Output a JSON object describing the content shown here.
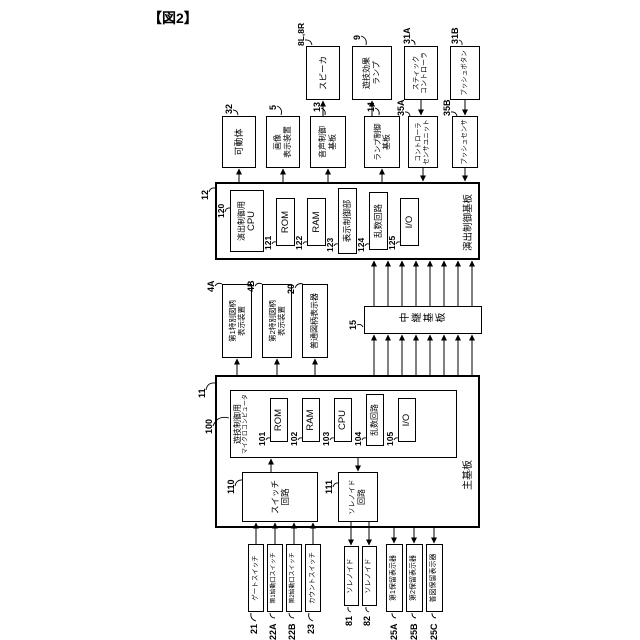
{
  "figure_label": "【図2】",
  "colors": {
    "ink": "#000000",
    "paper": "#ffffff"
  },
  "diagram": {
    "boxes": [
      {
        "name": "main-board",
        "x": 112,
        "y": 215,
        "w": 153,
        "h": 265,
        "bw": 2,
        "lines": []
      },
      {
        "name": "effect-control-board",
        "x": 380,
        "y": 215,
        "w": 78,
        "h": 265,
        "bw": 2,
        "lines": []
      },
      {
        "name": "game-control-microcomputer",
        "x": 182,
        "y": 230,
        "w": 68,
        "h": 227,
        "bw": 1.5,
        "align": "top",
        "lines": [
          {
            "t": "遊技制御用",
            "fs": 8
          },
          {
            "t": "マイクロコンピュータ",
            "fs": 6
          }
        ]
      },
      {
        "name": "relay-board",
        "x": 306,
        "y": 364,
        "w": 28,
        "h": 118,
        "bw": 1.5,
        "vert": true,
        "lines": [
          {
            "t": "中継基板",
            "fs": 10
          }
        ]
      },
      {
        "name": "gate-switch",
        "x": 28,
        "y": 248,
        "w": 68,
        "h": 16,
        "lines": [
          {
            "t": "ゲートスイッチ",
            "fs": 6.5
          }
        ]
      },
      {
        "name": "first-start-switch",
        "x": 28,
        "y": 267,
        "w": 68,
        "h": 16,
        "lines": [
          {
            "t": "第1始動口スイッチ",
            "fs": 6
          }
        ]
      },
      {
        "name": "second-start-switch",
        "x": 28,
        "y": 286,
        "w": 68,
        "h": 16,
        "lines": [
          {
            "t": "第2始動口スイッチ",
            "fs": 6
          }
        ]
      },
      {
        "name": "count-switch",
        "x": 28,
        "y": 305,
        "w": 68,
        "h": 16,
        "lines": [
          {
            "t": "カウントスイッチ",
            "fs": 6.5
          }
        ]
      },
      {
        "name": "solenoid-81",
        "x": 34,
        "y": 344,
        "w": 60,
        "h": 15,
        "lines": [
          {
            "t": "ソレノイド",
            "fs": 7
          }
        ]
      },
      {
        "name": "solenoid-82",
        "x": 34,
        "y": 362,
        "w": 60,
        "h": 15,
        "lines": [
          {
            "t": "ソレノイド",
            "fs": 7
          }
        ]
      },
      {
        "name": "first-hold-display",
        "x": 28,
        "y": 386,
        "w": 68,
        "h": 17,
        "lines": [
          {
            "t": "第1保留表示器",
            "fs": 7
          }
        ]
      },
      {
        "name": "second-hold-display",
        "x": 28,
        "y": 406,
        "w": 68,
        "h": 17,
        "lines": [
          {
            "t": "第2保留表示器",
            "fs": 7
          }
        ]
      },
      {
        "name": "normal-hold-display",
        "x": 28,
        "y": 426,
        "w": 68,
        "h": 17,
        "lines": [
          {
            "t": "普図保留表示器",
            "fs": 7
          }
        ]
      },
      {
        "name": "switch-circuit",
        "x": 118,
        "y": 242,
        "w": 50,
        "h": 76,
        "lines": [
          {
            "t": "スイッチ",
            "fs": 8.5
          },
          {
            "t": "回路",
            "fs": 8.5
          }
        ]
      },
      {
        "name": "solenoid-circuit",
        "x": 118,
        "y": 338,
        "w": 50,
        "h": 40,
        "lines": [
          {
            "t": "ソレノイド",
            "fs": 7
          },
          {
            "t": "回路",
            "fs": 8
          }
        ]
      },
      {
        "name": "main-rom",
        "x": 198,
        "y": 270,
        "w": 44,
        "h": 18,
        "lines": [
          {
            "t": "ROM",
            "fs": 9.5
          }
        ]
      },
      {
        "name": "main-ram",
        "x": 198,
        "y": 302,
        "w": 44,
        "h": 18,
        "lines": [
          {
            "t": "RAM",
            "fs": 9.5
          }
        ]
      },
      {
        "name": "main-cpu",
        "x": 198,
        "y": 334,
        "w": 44,
        "h": 18,
        "lines": [
          {
            "t": "CPU",
            "fs": 9.5
          }
        ]
      },
      {
        "name": "main-random-circuit",
        "x": 194,
        "y": 366,
        "w": 52,
        "h": 18,
        "lines": [
          {
            "t": "乱数回路",
            "fs": 8
          }
        ]
      },
      {
        "name": "main-io",
        "x": 198,
        "y": 398,
        "w": 44,
        "h": 18,
        "lines": [
          {
            "t": "I/O",
            "fs": 9.5
          }
        ]
      },
      {
        "name": "first-special-symbol-display",
        "x": 282,
        "y": 222,
        "w": 74,
        "h": 30,
        "lines": [
          {
            "t": "第1特別図柄",
            "fs": 7.5
          },
          {
            "t": "表示装置",
            "fs": 7.5
          }
        ]
      },
      {
        "name": "second-special-symbol-display",
        "x": 282,
        "y": 262,
        "w": 74,
        "h": 30,
        "lines": [
          {
            "t": "第2特別図柄",
            "fs": 7.5
          },
          {
            "t": "表示装置",
            "fs": 7.5
          }
        ]
      },
      {
        "name": "normal-symbol-display",
        "x": 282,
        "y": 302,
        "w": 74,
        "h": 26,
        "lines": [
          {
            "t": "普通図柄表示器",
            "fs": 8
          }
        ]
      },
      {
        "name": "effect-control-cpu",
        "x": 388,
        "y": 230,
        "w": 62,
        "h": 34,
        "lines": [
          {
            "t": "演出制御用",
            "fs": 8
          },
          {
            "t": "CPU",
            "fs": 9.5
          }
        ]
      },
      {
        "name": "effect-rom",
        "x": 394,
        "y": 276,
        "w": 48,
        "h": 19,
        "lines": [
          {
            "t": "ROM",
            "fs": 9.5
          }
        ]
      },
      {
        "name": "effect-ram",
        "x": 394,
        "y": 307,
        "w": 48,
        "h": 19,
        "lines": [
          {
            "t": "RAM",
            "fs": 9.5
          }
        ]
      },
      {
        "name": "display-control-unit",
        "x": 386,
        "y": 338,
        "w": 66,
        "h": 19,
        "lines": [
          {
            "t": "表示制御部",
            "fs": 8.5
          }
        ]
      },
      {
        "name": "effect-random-circuit",
        "x": 390,
        "y": 369,
        "w": 58,
        "h": 19,
        "lines": [
          {
            "t": "乱数回路",
            "fs": 8.5
          }
        ]
      },
      {
        "name": "effect-io",
        "x": 394,
        "y": 400,
        "w": 48,
        "h": 19,
        "lines": [
          {
            "t": "I/O",
            "fs": 9.5
          }
        ]
      },
      {
        "name": "movable-body",
        "x": 472,
        "y": 222,
        "w": 52,
        "h": 34,
        "lines": [
          {
            "t": "可動体",
            "fs": 9
          }
        ]
      },
      {
        "name": "image-display-device",
        "x": 472,
        "y": 266,
        "w": 52,
        "h": 34,
        "lines": [
          {
            "t": "画像",
            "fs": 8
          },
          {
            "t": "表示装置",
            "fs": 8
          }
        ]
      },
      {
        "name": "sound-control-board",
        "x": 472,
        "y": 310,
        "w": 52,
        "h": 36,
        "lines": [
          {
            "t": "音声制御",
            "fs": 8
          },
          {
            "t": "基板",
            "fs": 8
          }
        ]
      },
      {
        "name": "lamp-control-board",
        "x": 472,
        "y": 364,
        "w": 52,
        "h": 36,
        "lines": [
          {
            "t": "ランプ制御",
            "fs": 7.5
          },
          {
            "t": "基板",
            "fs": 8
          }
        ]
      },
      {
        "name": "controller-sensor-unit",
        "x": 472,
        "y": 408,
        "w": 52,
        "h": 30,
        "lines": [
          {
            "t": "コントローラ",
            "fs": 6.5
          },
          {
            "t": "センサユニット",
            "fs": 6.5
          }
        ]
      },
      {
        "name": "push-sensor",
        "x": 472,
        "y": 452,
        "w": 52,
        "h": 26,
        "lines": [
          {
            "t": "プッシュセンサ",
            "fs": 6.5
          }
        ]
      },
      {
        "name": "speaker",
        "x": 540,
        "y": 306,
        "w": 54,
        "h": 34,
        "lines": [
          {
            "t": "スピーカ",
            "fs": 8.5
          }
        ]
      },
      {
        "name": "game-effect-lamp",
        "x": 540,
        "y": 352,
        "w": 54,
        "h": 40,
        "lines": [
          {
            "t": "遊技効果",
            "fs": 8
          },
          {
            "t": "ランプ",
            "fs": 8
          }
        ]
      },
      {
        "name": "stick-controller",
        "x": 540,
        "y": 404,
        "w": 54,
        "h": 34,
        "lines": [
          {
            "t": "スティック",
            "fs": 7
          },
          {
            "t": "コントローラ",
            "fs": 7
          }
        ]
      },
      {
        "name": "push-button",
        "x": 540,
        "y": 450,
        "w": 54,
        "h": 30,
        "lines": [
          {
            "t": "プッシュボタン",
            "fs": 6.5
          }
        ]
      }
    ],
    "board_titles": [
      {
        "name": "main-board-title",
        "t": "主基板",
        "x": 150,
        "y": 459,
        "fs": 10
      },
      {
        "name": "effect-board-title",
        "t": "演出制御基板",
        "x": 389,
        "y": 460,
        "fs": 9.5
      }
    ],
    "ref_labels": [
      {
        "t": "21",
        "x": 6,
        "y": 249,
        "fs": 9,
        "leader": [
          19,
          256,
          27,
          251
        ]
      },
      {
        "t": "22A",
        "x": 0,
        "y": 268,
        "fs": 9,
        "leader": [
          22,
          275,
          27,
          270
        ]
      },
      {
        "t": "22B",
        "x": 0,
        "y": 287,
        "fs": 9,
        "leader": [
          22,
          294,
          27,
          289
        ]
      },
      {
        "t": "23",
        "x": 6,
        "y": 306,
        "fs": 9,
        "leader": [
          19,
          313,
          27,
          309
        ]
      },
      {
        "t": "81",
        "x": 14,
        "y": 344,
        "fs": 9,
        "leader": [
          28,
          351,
          33,
          348
        ]
      },
      {
        "t": "82",
        "x": 14,
        "y": 362,
        "fs": 9,
        "leader": [
          28,
          369,
          33,
          366
        ]
      },
      {
        "t": "25A",
        "x": 0,
        "y": 389,
        "fs": 9,
        "leader": [
          22,
          396,
          27,
          392
        ]
      },
      {
        "t": "25B",
        "x": 0,
        "y": 409,
        "fs": 9,
        "leader": [
          22,
          416,
          27,
          412
        ]
      },
      {
        "t": "25C",
        "x": 0,
        "y": 429,
        "fs": 9,
        "leader": [
          22,
          436,
          27,
          432
        ]
      },
      {
        "t": "110",
        "x": 146,
        "y": 226,
        "fs": 9,
        "leader": [
          154,
          235,
          160,
          243
        ]
      },
      {
        "t": "111",
        "x": 146,
        "y": 324,
        "fs": 9,
        "leader": [
          153,
          333,
          157,
          339
        ]
      },
      {
        "t": "100",
        "x": 206,
        "y": 204,
        "fs": 9,
        "leader": [
          214,
          213,
          222,
          229
        ]
      },
      {
        "t": "11",
        "x": 242,
        "y": 197,
        "fs": 9,
        "leader": [
          250,
          206,
          257,
          215
        ]
      },
      {
        "t": "101",
        "x": 194,
        "y": 257,
        "fs": 8.5,
        "leader": [
          200,
          266,
          202,
          270
        ]
      },
      {
        "t": "102",
        "x": 194,
        "y": 289,
        "fs": 8.5,
        "leader": [
          200,
          298,
          202,
          302
        ]
      },
      {
        "t": "103",
        "x": 194,
        "y": 321,
        "fs": 8.5,
        "leader": [
          200,
          330,
          202,
          334
        ]
      },
      {
        "t": "104",
        "x": 194,
        "y": 353,
        "fs": 8.5,
        "leader": [
          200,
          362,
          202,
          366
        ]
      },
      {
        "t": "105",
        "x": 194,
        "y": 385,
        "fs": 8.5,
        "leader": [
          200,
          394,
          202,
          398
        ]
      },
      {
        "t": "4A",
        "x": 348,
        "y": 206,
        "fs": 9,
        "leader": [
          354,
          215,
          356,
          222
        ]
      },
      {
        "t": "4B",
        "x": 348,
        "y": 246,
        "fs": 9,
        "leader": [
          354,
          255,
          356,
          262
        ]
      },
      {
        "t": "20",
        "x": 346,
        "y": 286,
        "fs": 9,
        "leader": [
          352,
          295,
          356,
          303
        ]
      },
      {
        "t": "15",
        "x": 310,
        "y": 348,
        "fs": 9,
        "leader": [
          315,
          357,
          313,
          363
        ]
      },
      {
        "t": "12",
        "x": 440,
        "y": 200,
        "fs": 9,
        "leader": [
          448,
          209,
          452,
          215
        ]
      },
      {
        "t": "120",
        "x": 422,
        "y": 216,
        "fs": 8.5,
        "leader": [
          428,
          225,
          432,
          230
        ]
      },
      {
        "t": "121",
        "x": 390,
        "y": 263,
        "fs": 8.5,
        "leader": [
          396,
          272,
          398,
          276
        ]
      },
      {
        "t": "122",
        "x": 390,
        "y": 294,
        "fs": 8.5,
        "leader": [
          396,
          303,
          398,
          307
        ]
      },
      {
        "t": "123",
        "x": 388,
        "y": 325,
        "fs": 8.5,
        "leader": [
          394,
          334,
          396,
          338
        ]
      },
      {
        "t": "124",
        "x": 388,
        "y": 356,
        "fs": 8.5,
        "leader": [
          394,
          365,
          396,
          369
        ]
      },
      {
        "t": "125",
        "x": 390,
        "y": 387,
        "fs": 8.5,
        "leader": [
          396,
          396,
          398,
          400
        ]
      },
      {
        "t": "32",
        "x": 526,
        "y": 224,
        "fs": 9,
        "leader": [
          530,
          233,
          525,
          238
        ]
      },
      {
        "t": "5",
        "x": 530,
        "y": 268,
        "fs": 9,
        "leader": [
          534,
          277,
          525,
          281
        ]
      },
      {
        "t": "13",
        "x": 528,
        "y": 312,
        "fs": 9,
        "leader": [
          532,
          321,
          525,
          325
        ]
      },
      {
        "t": "14",
        "x": 528,
        "y": 366,
        "fs": 9,
        "leader": [
          532,
          375,
          525,
          379
        ]
      },
      {
        "t": "35A",
        "x": 524,
        "y": 396,
        "fs": 9,
        "leader": [
          528,
          405,
          524,
          410
        ]
      },
      {
        "t": "35B",
        "x": 524,
        "y": 442,
        "fs": 9,
        "leader": [
          528,
          451,
          524,
          457
        ]
      },
      {
        "t": "8L,8R",
        "x": 594,
        "y": 296,
        "fs": 8.5,
        "leader": [
          600,
          305,
          595,
          312
        ]
      },
      {
        "t": "9",
        "x": 600,
        "y": 352,
        "fs": 9,
        "leader": [
          604,
          361,
          595,
          366
        ]
      },
      {
        "t": "31A",
        "x": 596,
        "y": 402,
        "fs": 9,
        "leader": [
          600,
          411,
          595,
          415
        ]
      },
      {
        "t": "31B",
        "x": 596,
        "y": 450,
        "fs": 9,
        "leader": [
          600,
          459,
          595,
          462
        ]
      }
    ],
    "arrows": [
      [
        96,
        256,
        117,
        256
      ],
      [
        96,
        275,
        117,
        275
      ],
      [
        96,
        294,
        117,
        294
      ],
      [
        96,
        313,
        117,
        313
      ],
      [
        168,
        271,
        181,
        271
      ],
      [
        182,
        358,
        169,
        358
      ],
      [
        118,
        351,
        95,
        351
      ],
      [
        118,
        369,
        95,
        369
      ],
      [
        112,
        394,
        97,
        394
      ],
      [
        112,
        414,
        97,
        414
      ],
      [
        112,
        434,
        97,
        434
      ],
      [
        265,
        237,
        281,
        237
      ],
      [
        265,
        277,
        281,
        277
      ],
      [
        265,
        315,
        281,
        315
      ],
      [
        265,
        374,
        305,
        374
      ],
      [
        265,
        388,
        305,
        388
      ],
      [
        265,
        402,
        305,
        402
      ],
      [
        265,
        416,
        305,
        416
      ],
      [
        265,
        430,
        305,
        430
      ],
      [
        265,
        444,
        305,
        444
      ],
      [
        265,
        458,
        305,
        458
      ],
      [
        265,
        472,
        305,
        472
      ],
      [
        334,
        374,
        379,
        374
      ],
      [
        334,
        388,
        379,
        388
      ],
      [
        334,
        402,
        379,
        402
      ],
      [
        334,
        416,
        379,
        416
      ],
      [
        334,
        430,
        379,
        430
      ],
      [
        334,
        444,
        379,
        444
      ],
      [
        334,
        458,
        379,
        458
      ],
      [
        334,
        472,
        379,
        472
      ],
      [
        458,
        239,
        471,
        239
      ],
      [
        458,
        283,
        471,
        283
      ],
      [
        458,
        328,
        471,
        328
      ],
      [
        458,
        382,
        471,
        382
      ],
      [
        472,
        423,
        459,
        423
      ],
      [
        472,
        465,
        459,
        465
      ],
      [
        524,
        323,
        539,
        323
      ],
      [
        524,
        372,
        539,
        372
      ],
      [
        540,
        421,
        525,
        421
      ],
      [
        540,
        465,
        525,
        465
      ]
    ]
  }
}
